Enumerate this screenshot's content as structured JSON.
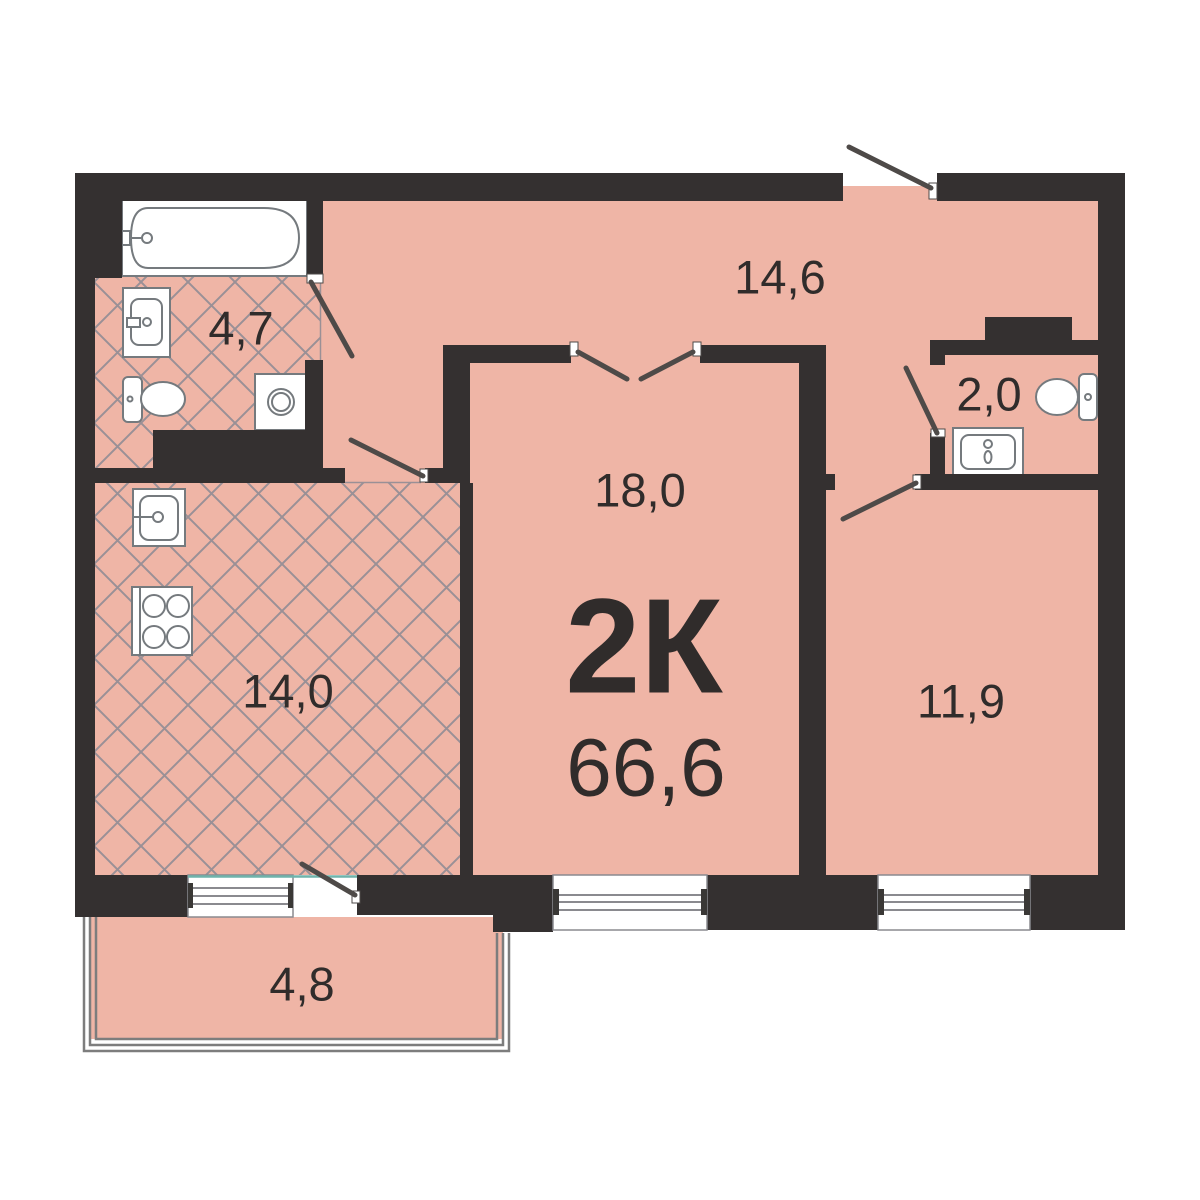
{
  "plan": {
    "type_label": "2К",
    "total_area": "66,6",
    "rooms": {
      "bathroom": {
        "area": "4,7"
      },
      "hall": {
        "area": "14,6"
      },
      "wc": {
        "area": "2,0"
      },
      "living_room": {
        "area": "18,0"
      },
      "kitchen": {
        "area": "14,0"
      },
      "bedroom": {
        "area": "11,9"
      },
      "balcony": {
        "area": "4,8"
      }
    }
  },
  "colors": {
    "bg": "#ffffff",
    "wall": "#343030",
    "floor": "#efb5a6",
    "tile": "#9a9096",
    "fixture": "#757a7e",
    "door": "#4e4a48",
    "window": "#8a8a8f",
    "cap": "#3a3836",
    "rail": "#7d7d7d",
    "glass": "#6fb3ab",
    "text": "#302c2b"
  }
}
